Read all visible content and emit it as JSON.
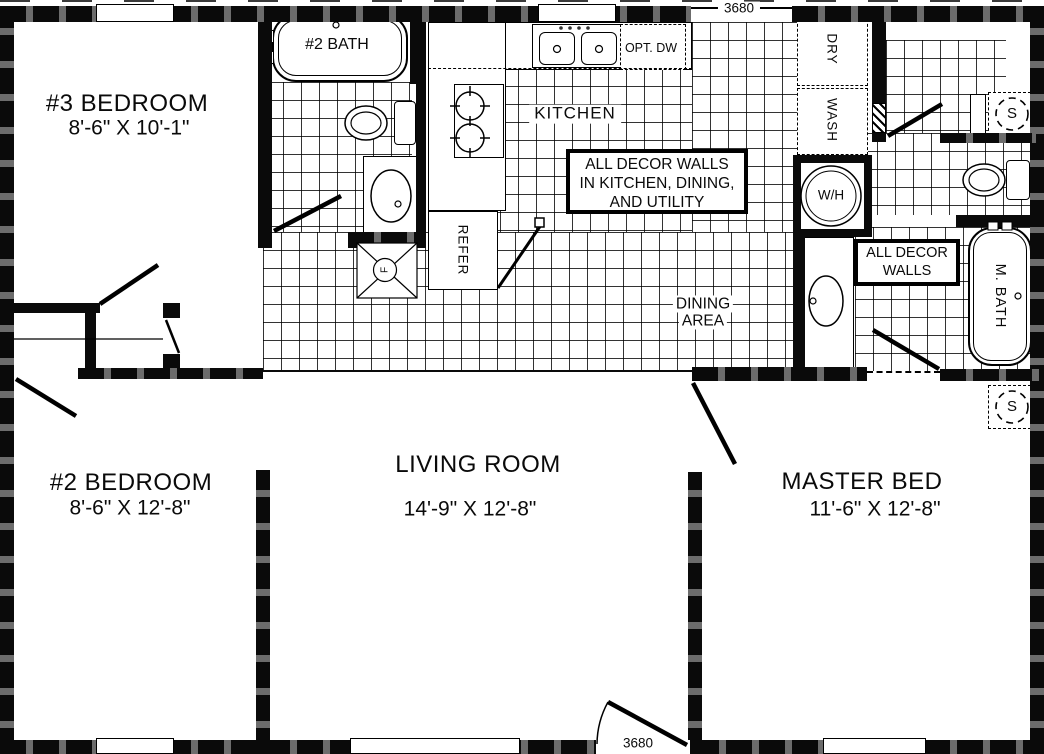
{
  "plan": {
    "rooms": {
      "bedroom3": {
        "name": "#3 BEDROOM",
        "dims": "8'-6\" X 10'-1\""
      },
      "bedroom2": {
        "name": "#2 BEDROOM",
        "dims": "8'-6\" X 12'-8\""
      },
      "living_room": {
        "name": "LIVING ROOM",
        "dims": "14'-9\" X 12'-8\""
      },
      "master_bedroom": {
        "name": "MASTER BED",
        "dims": "11'-6\" X 12'-8\""
      },
      "kitchen": {
        "name": "KITCHEN"
      },
      "dining_area": {
        "line1": "DINING",
        "line2": "AREA"
      },
      "bath2": {
        "name": "#2 BATH"
      },
      "master_bath": {
        "name": "M. BATH"
      }
    },
    "fixtures": {
      "refrigerator": "REFER",
      "optional_dishwasher": "OPT. DW",
      "dryer": "DRY",
      "washer": "WASH",
      "water_heater": "W/H",
      "furnace": "F",
      "shelf": "S"
    },
    "doors": {
      "rear_door_size": "3680",
      "front_door_size": "3680"
    },
    "notes": {
      "decor_main": [
        "ALL DECOR WALLS",
        "IN KITCHEN, DINING,",
        "AND UTILITY"
      ],
      "decor_bath": [
        "ALL DECOR",
        "WALLS"
      ]
    },
    "colors": {
      "wall": "#000000",
      "floor": "#ffffff"
    }
  }
}
